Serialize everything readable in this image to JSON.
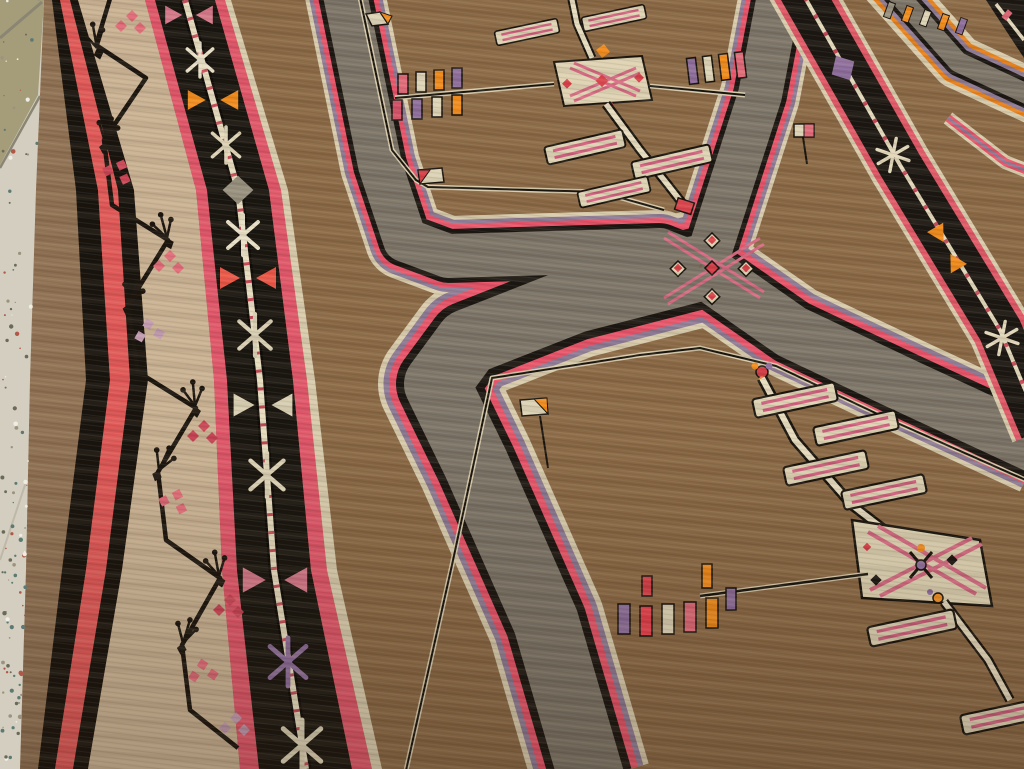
{
  "scene": {
    "type": "photograph",
    "subject": "Antique handwoven tribal rug (Anatolian Kars / Kazak style) lying on a speckled terrazzo floor, photographed at an oblique angle",
    "text_visible": false
  },
  "palette": {
    "floor_light": "#d3cec0",
    "floor_tile_olive": "#a59c79",
    "floor_grout": "#8a8673",
    "selvedge_brown": "#8f7154",
    "stripe_black": "#17130e",
    "stripe_red": "#e05858",
    "border_cream": "#c9b294",
    "border_cream_light": "#d8c7ab",
    "vine_black": "#1a150f",
    "flower_pink": "#e06a78",
    "flower_red": "#c94456",
    "flower_lilac": "#c09ab0",
    "pole_border_black": "#181510",
    "pole_cream": "#e6dcc0",
    "guard_pink": "#e0566a",
    "field_brown": "#8a6946",
    "field_brown_light": "#9b7a52",
    "band_gray": "#7b7468",
    "band_stripe_cream": "#d8ccae",
    "band_stripe_purple": "#8d7b97",
    "band_stripe_red": "#e8536a",
    "band_stripe_black": "#1a1612",
    "medallion_cream": "#ded3b4",
    "medallion_pink": "#d66a84",
    "medallion_red": "#d8404a",
    "bar_cream": "#ddd3b5",
    "bar_stripe_pink": "#d06080",
    "tassel_orange": "#f18c1e",
    "tassel_purple": "#8e6f9e",
    "tassel_pink": "#e06a7a",
    "tassel_cream": "#ddd4b8",
    "tassel_red": "#e8404e",
    "diag_border_orange": "#e8821c",
    "shadow": "#2a1a0c"
  },
  "floor": {
    "description": "speckled terrazzo tiles along left edge, olive-tan tile at top with diagonal grout lines, whiter tile below",
    "speckle_colors": [
      "#efece1",
      "#9a947e",
      "#6b6a58",
      "#5d7a72",
      "#b05848"
    ]
  },
  "rug": {
    "edge_stripes": [
      {
        "name": "brown selvedge",
        "color": "#8f7154"
      },
      {
        "name": "black guard",
        "color": "#17130e"
      },
      {
        "name": "red guard",
        "color": "#e05858"
      },
      {
        "name": "black guard",
        "color": "#17130e"
      }
    ],
    "borders": [
      {
        "name": "ivory vine border",
        "background": "#c9b294",
        "motifs": "black angular vine meander with sprigs and pink blossom clusters"
      },
      {
        "name": "red guard stripe",
        "color": "#e0566a"
      },
      {
        "name": "black pole border",
        "background": "#181510",
        "pole_color": "#e6dcc0",
        "motif_sequence": [
          {
            "type": "triangle-pair",
            "color": "#d4788a"
          },
          {
            "type": "cross-x",
            "color": "#e8e0c8"
          },
          {
            "type": "triangle-pair",
            "color": "#f18c1e"
          },
          {
            "type": "cross-x",
            "color": "#ddd4b8"
          },
          {
            "type": "diamond",
            "color": "#97907f"
          },
          {
            "type": "cross-x",
            "color": "#e8e0c8"
          },
          {
            "type": "triangle-pair",
            "color": "#ea5648"
          },
          {
            "type": "cross-x",
            "color": "#d8cfb4"
          },
          {
            "type": "triangle-pair",
            "color": "#d8d0b4"
          },
          {
            "type": "cross-x",
            "color": "#ddd4b8"
          },
          {
            "type": "triangle-pair",
            "color": "#d4788a"
          },
          {
            "type": "cross-x",
            "color": "#8e6f9e"
          },
          {
            "type": "cross-x",
            "color": "#ddd4b8"
          }
        ]
      },
      {
        "name": "pink guard stripe",
        "color": "#e0566a"
      }
    ],
    "field": {
      "background": "#8a6946",
      "compartment_band": {
        "core": "#7b7468",
        "edge_stripes": [
          "#d8ccae",
          "#8d7b97",
          "#e8536a",
          "#1a1612"
        ]
      },
      "junction_motif": {
        "description": "pink diagonal cross star with red-dotted cream squares",
        "colors": [
          "#d66a84",
          "#d8404a",
          "#ded3b4"
        ]
      },
      "compartments": [
        {
          "position": "top-left",
          "elements": [
            "cream diamond medallion with pink cross and red dots",
            "vertical pole with striped cream bars",
            "left stem with hanging tassels",
            "right stem with upright tassels",
            "corner pennants cream/orange and cream/red",
            "red pole tip"
          ],
          "tassel_colors_left": [
            "#e06a7a",
            "#ddd4b8",
            "#f18c1e",
            "#8e6f9e",
            "#d4526a",
            "#8e6f9e",
            "#ddd4b8",
            "#f18c1e"
          ],
          "tassel_colors_right": [
            "#8e6f9e",
            "#ddd4b8",
            "#f18c1e",
            "#e06a7a"
          ]
        },
        {
          "position": "top-right",
          "elements": [
            "small cream and pink pennant with stem"
          ]
        },
        {
          "position": "bottom-right",
          "elements": [
            "large cream diamond medallion with pink hatching and dark rosettes",
            "diagonal pole with striped cream bars",
            "rosette finial at pole top",
            "left stem with hanging tassels",
            "corner pennant cream/orange",
            "cream-orange tick at upper right"
          ],
          "tassel_colors": [
            "#8e6f9e",
            "#e8404e",
            "#ddd4b8",
            "#e06a7a",
            "#f18c1e",
            "#8e6f9e"
          ]
        },
        {
          "position": "bottom-left",
          "elements": [
            "plain brown margin"
          ]
        }
      ]
    },
    "diagonal_minor_border": {
      "background": "#1a1612",
      "pole": "#e2d8bc",
      "edge_stripe": "#e05868",
      "motifs": [
        "purple diamond",
        "cream cross-x",
        "orange triangle pair",
        "cream cross-x"
      ]
    },
    "top_right_corner": {
      "elements": [
        "gray chevron band edged cream, orange and purple",
        "thin striped inner chevron",
        "row of colored dashes",
        "black corner band with cream pole"
      ]
    }
  }
}
